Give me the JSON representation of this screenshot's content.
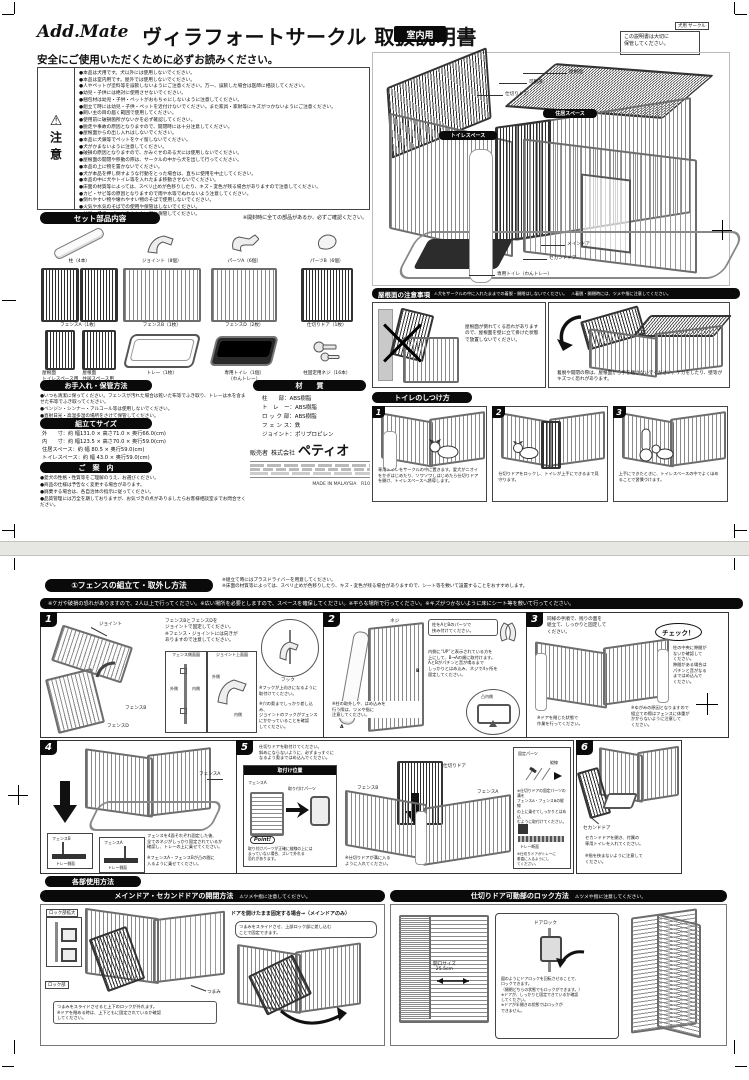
{
  "doc": {
    "brand": "Add.Mate",
    "title": "ヴィラフォートサークル 取扱説明書",
    "use_badge": "室内用",
    "corner_tag": "犬用 サークル",
    "keep_note": "この説明書は大切に\n保管してください。"
  },
  "safety": {
    "heading": "安全にご使用いただくために必ずお読みください。",
    "mark": "⚠",
    "label": "注意",
    "items": [
      "●本品は犬用です。犬以外には使用しないでください。",
      "●本品は室内用です。屋外では使用しないでください。",
      "●人やペットが塗料等を誤飲しないようにご注意ください。万一、誤飲した場合は医師に相談してください。",
      "●幼児・子供には絶対に使用させないでください。",
      "●梱包材は幼児・子供・ペットがおもちゃにしないように注意してください。",
      "●組立て時には幼児・子供・ペットを近付けないでください。また家具・家財等にキズがつかないようにご注意ください。",
      "●飼い主の目の届く範囲で使用してください。",
      "●使用前に破損箇所がないかを必ず確認してください。",
      "●脱走や事故の原因となりますので、開閉時には十分注意してください。",
      "●屋根面からの出し入れはしないでください。",
      "●本品に犬鎖等でペットをケイ留しないでください。",
      "●犬がかまないように注意してください。",
      "●破損の原因となりますので、かみぐせのある犬には使用しないでください。",
      "●屋根面の開閉や移動の際は、サークルの中から犬を出して行ってください。",
      "●本品の上に物を置かないでください。",
      "●犬が本品を押し倒すような行動をとった場合は、直ちに使用を中止してください。",
      "●本品の中に犬やトイレ等を入れたまま移動させないでください。",
      "●床面の材質等によっては、スベリ止めが色移りしたり、キズ・変色が残る場合がありますので注意してください。",
      "●カビ・サビ等の原因となりますので雨や水等でぬれないよう注意してください。",
      "●倒れやすい物や壊れやすい物のそばで使用しないでください。",
      "●火気や水気のそばでの使用や保管はしないでください。",
      "●幼児・子供・ペットのふれない所に保管してください。"
    ]
  },
  "parts": {
    "header": "セット部品内容",
    "note": "※開封時に全ての部品があるか、必ずご確認ください。",
    "post": "柱（4本）",
    "joint": "ジョイント（8個）",
    "part_a": "パーツA（6個）",
    "part_b": "パーツB（6個）",
    "fence_a": "フェンスA（1枚）",
    "fence_b": "フェンスB（1枚）",
    "fence_d": "フェンスD（2枚）",
    "divider_door": "仕切りドア（1枚）",
    "roof_toilet": "屋根面\nトイレスペース用\n（1枚）",
    "roof_living": "屋根面\n住居スペース用\n（1枚）",
    "tray": "トレー（1枚）",
    "toilet": "専用トイレ（1個）\n（わんトレー）",
    "screws": "柱固定用ネジ（16本）"
  },
  "care": {
    "header": "お手入れ・保管方法",
    "items": [
      "●いつも清潔に保ってください。フェンスが汚れた場合は乾いた布等でふき取り、トレーは水を含ませた布等でふき取ってください。",
      "●ベンジン・シンナー・アルコール等は使用しないでください。",
      "●直射日光・高温多湿の場所をさけて保管してください。"
    ]
  },
  "size": {
    "header": "組立てサイズ",
    "rows": [
      "外　　寸：約 幅131.0 × 高さ71.0 × 奥行66.0(cm)",
      "内　　寸：約 幅123.5 × 高さ70.0 × 奥行59.0(cm)",
      "住居スペース：約 幅 80.5 × 奥行59.0(cm)",
      "トイレスペース：約 幅 43.0 × 奥行59.0(cm)"
    ]
  },
  "info": {
    "header": "ご　案　内",
    "items": [
      "●愛犬の性格・性質等をご理解のうえ、お選びください。",
      "●商品の仕様は予告なく変更する場合があります。",
      "●廃棄する場合は、各自治体の指示に従ってください。",
      "●品質管理には万全を期しておりますが、お気づきの点がありましたらお客様相談室までお問合せください。"
    ]
  },
  "material": {
    "header": "材　　質",
    "rows": [
      "柱　　部：ABS樹脂",
      "ト　レ　ー：ABS樹脂",
      "ロ ッ ク 部：ABS樹脂",
      "フ ェ ン ス：鉄",
      "ジョイント：ポリプロピレン"
    ]
  },
  "seller": {
    "label": "販売者",
    "company": "株式会社",
    "brand": "ペティオ",
    "origin": "MADE IN MALAYSIA　R10"
  },
  "overview": {
    "roof": "屋根面",
    "movable": "可動部",
    "divider": "仕切りドア",
    "living": "住居スペース",
    "toilet_space": "トイレスペース",
    "main_door": "メインドア",
    "second_door": "セカンドドア",
    "toilet": "専用トイレ（わんトレー）"
  },
  "roof_caution": {
    "header": "屋根面の注意事項",
    "note1": "⚠犬をサークルの中に入れたままでの着脱・開閉はしないでください。",
    "note2": "⚠着脱・開閉時には、ツメや指に注意してください。",
    "box1": "屋根面が倒れてくる恐れがありますので、屋根面を壁に立て掛けた状態で放置しないでください。",
    "box2": "着脱や開閉の際は、屋根面から手を離さないでください。ケガをしたり、壁等がキズつく恐れがあります。"
  },
  "toilet_training": {
    "header": "トイレのしつけ方",
    "steps": [
      {
        "num": "1",
        "text": "専用トイレをサークルの中に置きます。愛犬がニオイをかぎはじめたり、ソワソワしはじめたら仕切りドアを開け、トイレスペースへ誘導します。"
      },
      {
        "num": "2",
        "text": "仕切りドアをロックし、トイレが上手にできるまで見守ります。"
      },
      {
        "num": "3",
        "text": "上手にできたときに、トイレスペースの中でよくほめることで習慣づけます。"
      }
    ]
  },
  "assembly": {
    "header": "①フェンスの組立て・取外し方法",
    "note1": "※組立て時にはプラスドライバーを用意してください。",
    "note2": "※床面の材質等によっては、スベリ止めが色移りしたり、キズ・変色が残る場合がありますので、シート等を敷いて設置することをおすすめします。",
    "warning": "※ケガや破損の恐れがありますので、2人以上で行ってください。※広い場所を必要としますので、スペースを確保してください。※平らな場所で行ってください。※キズがつかないように床にシート等を敷いて行ってください。",
    "s1": {
      "num": "1",
      "joint": "ジョイント",
      "fence_b": "フェンスB",
      "fence_d": "フェンスD",
      "text": "フェンスBとフェンスDを\nジョイントで固定してください。\n※フェンス・ジョイントには向きが\nありますので注意してください。",
      "inset1": "フェンス側面図",
      "inset2": "ジョイント上面図",
      "outside": "外側",
      "inside": "内側",
      "hook": "フック",
      "note1": "※フックが上向きになるように\n取付けてください。",
      "note2": "※穴の奥までしっかり差し込み、\nジョイントのフックがフェンス\nにかかっていることを確認\nしてください。"
    },
    "s2": {
      "num": "2",
      "screw": "ネジ",
      "a": "A",
      "b": "B",
      "text1": "柱をAとBのパーツで\n挟み付けてください。",
      "text2": "内側に“UP”と表示されている方を\n上にして、B→Aの順に取付けます。\nAとBがパチンと音が鳴るまで\nしっかりとはめ込み、ネジで4ヶ所を\n固定してください。",
      "note": "※柱の取外しや、はめ込みを\n行う際は、ツメや指に\n注意してください。",
      "inset": "凸内側"
    },
    "s3": {
      "num": "3",
      "text": "同様の手順で、残りの面を\n組立て、しっかりと固定して\nください。",
      "check": "チェック！",
      "check_text": "柱の中央に隙間が\nないか確認して\nください。\n隙間がある場合は\nパチンと音がなる\nまではめ込んで\nください。",
      "note1": "※ゆがみの原因となりますので\n組立ての際はフェンスに体重が\nかからないように注意して\nください。",
      "note2": "※ドアを閉じた状態で\n作業を行ってください。"
    },
    "s4": {
      "num": "4",
      "fence_a": "フェンスA",
      "inset_b": "フェンスB",
      "inset_a": "フェンスA",
      "tray_side": "トレー側面",
      "text": "フェンスを4面それぞれ固定した後、\n全てのネジがしっかり固定されているか\n確認し、トレーの上に乗せてください。",
      "note": "※フェンスA・フェンスBが凸の間に\n入るように乗せてください。"
    },
    "s5": {
      "num": "5",
      "text": "仕切りドアを取付けてください。\n斜めにならないように、必ずまっすぐに\nなるよう奥まではめ込んでください。",
      "inset_title": "取付け位置",
      "fence_a": "フェンスA",
      "part": "取り付けパーツ",
      "fence_b": "フェンスB",
      "divider": "仕切りドア",
      "vline": "縦線",
      "fix_part": "固定パーツ",
      "point": "Point!",
      "point_text": "取り付けパーツが正確に縦線の上には\nまっていない場合、ズレて外れる\n恐れがあります。",
      "note1": "※仕切りドアの固定パーツの溝を\nフェンスA・フェンスBの縦線\nの上に乗せてしっかりとはめ込\nむように取付けてください。",
      "note2": "※仕切りドアが溝に入る\nように入れてください。",
      "note3": "※仕切りドアがトレーに\n垂直に入るようにし\nてください。",
      "tray_sec": "トレー断面"
    },
    "s6": {
      "num": "6",
      "second": "セカンドドア",
      "text": "セカンドドアを開き、付属の\n専用トイレを入れてください。",
      "note": "※指を挟まないように注意して\nください。"
    }
  },
  "usage": {
    "header": "各部使用方法",
    "door": {
      "title": "メインドア・セカンドドアの開閉方法",
      "caution": "⚠ツメや指に注意してください。",
      "zoom": "ロック部拡大",
      "lock": "ロック部",
      "knob": "つまみ",
      "caption": "つまみをスライドさせると上下のロックが外れます。\n※ドアを閉める時は、上下ともに固定されているか確認\nしてください。",
      "open_title": "ドアを開けたまま固定する場合→（メインドアのみ）",
      "bubble": "つまみをスライドさせ、上部ロック部に差し込む\nことで固定できます。"
    },
    "divider": {
      "title": "仕切りドア可動部のロック方法",
      "caution": "⚠ツメや指に注意してください。",
      "opening": "開口サイズ\n25.5cm",
      "lock": "ドアロック",
      "caption": "図のようにドアロックを回転させることで、\nロックできます。\n（開閉どちらの状態でもロックができます。）\n※ドアが、しっかりと固定できているか確認\nしてください。\n※ドアが半開きの状態ではロックが\nできません。"
    }
  }
}
